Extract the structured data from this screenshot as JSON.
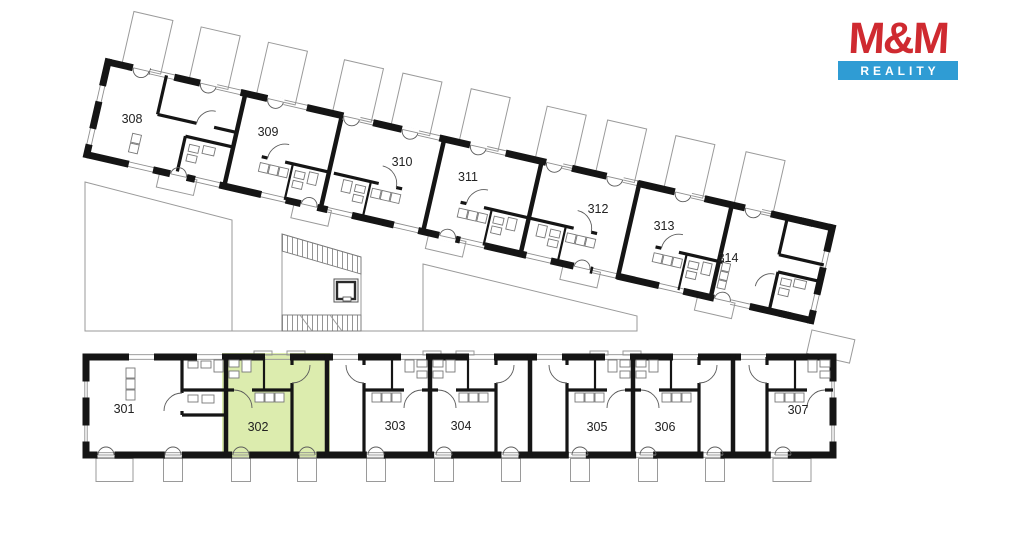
{
  "logo": {
    "title": "M&M",
    "subtitle": "REALITY",
    "colors": {
      "red": "#cf2a30",
      "blue": "#2f9cd4"
    }
  },
  "plan": {
    "type": "floor-plan",
    "highlight": {
      "number": "302",
      "color": "#dcecae"
    },
    "colors": {
      "walls": "#151515",
      "outlines": "#9a9a9a"
    },
    "apartments": {
      "top": [
        {
          "number": "308"
        },
        {
          "number": "309"
        },
        {
          "number": "310"
        },
        {
          "number": "311"
        },
        {
          "number": "312"
        },
        {
          "number": "313"
        },
        {
          "number": "314"
        }
      ],
      "bottom": [
        {
          "number": "301"
        },
        {
          "number": "302"
        },
        {
          "number": "303"
        },
        {
          "number": "304"
        },
        {
          "number": "305"
        },
        {
          "number": "306"
        },
        {
          "number": "307"
        }
      ]
    }
  }
}
